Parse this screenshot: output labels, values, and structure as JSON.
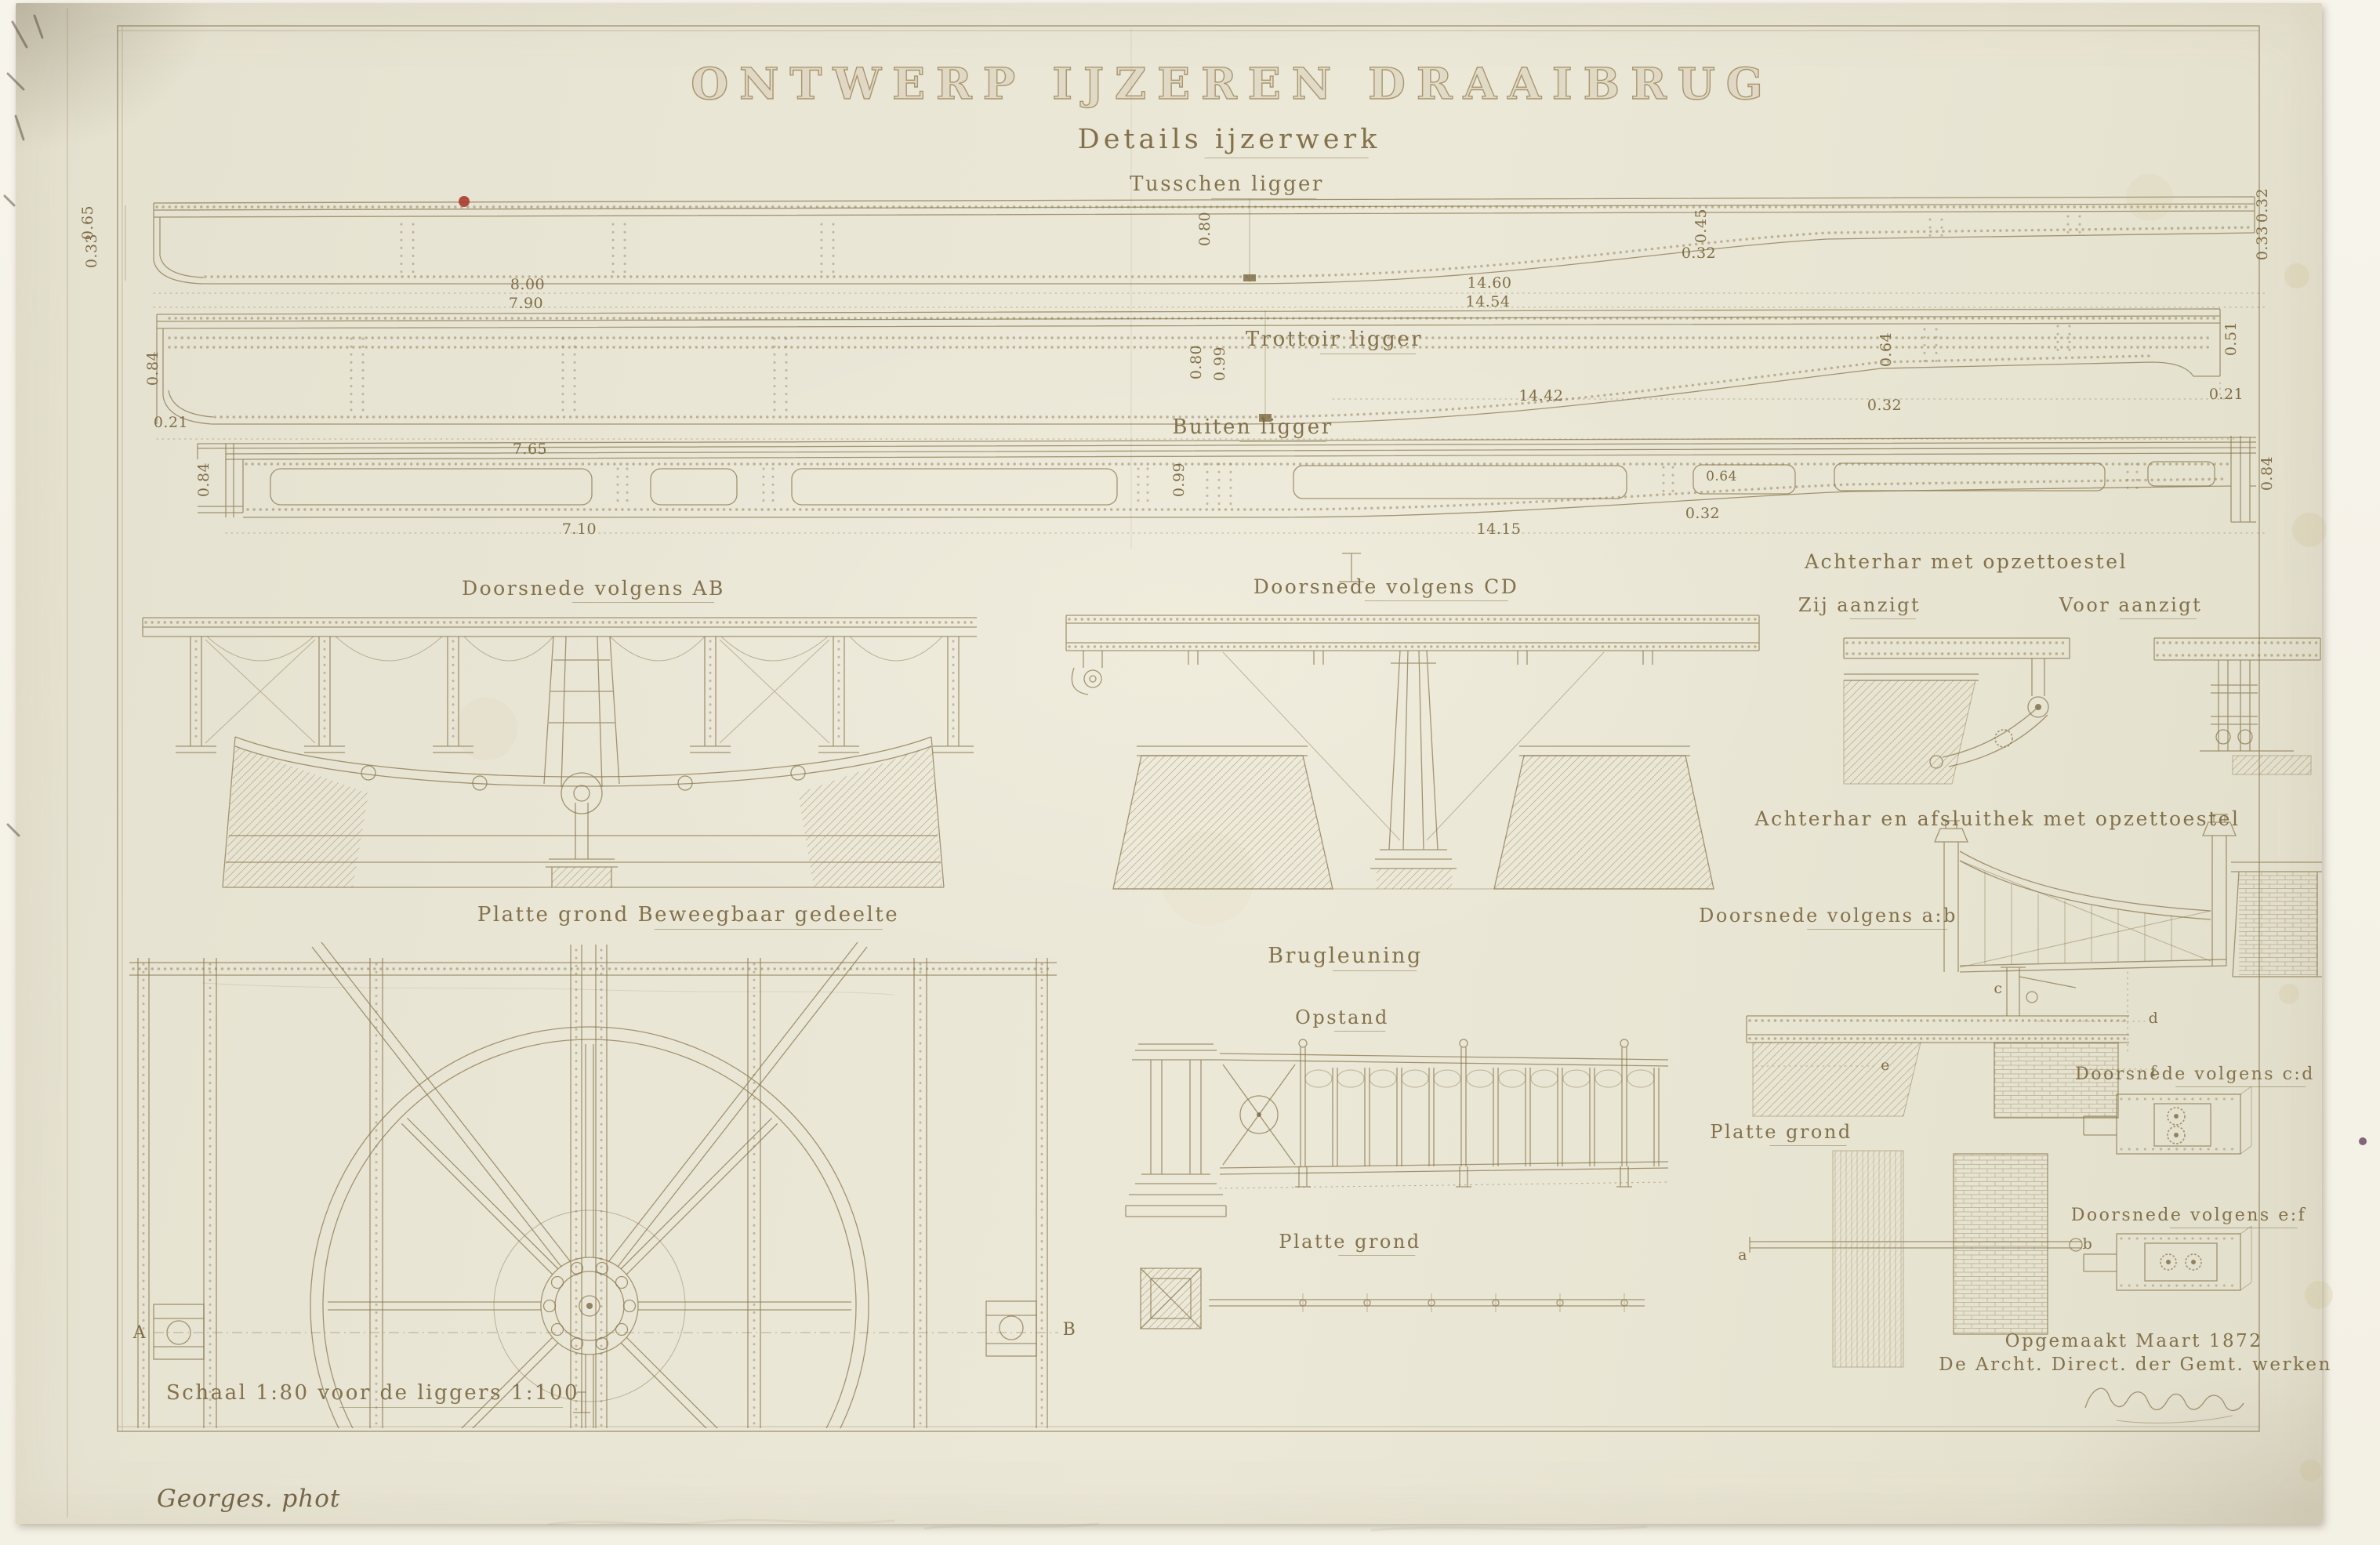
{
  "header": {
    "title": "ONTWERP IJZEREN DRAAIBRUG",
    "subtitle": "Details ijzerwerk"
  },
  "girders": {
    "tusschen": {
      "label": "Tusschen ligger",
      "dims": {
        "e1": "0.65",
        "e2": "0.33",
        "q1": "8.00",
        "q2": "7.90",
        "mid": "0.80",
        "h1": "14.60",
        "h2": "14.54",
        "t1": "0.45",
        "t2": "0.32",
        "r1": "0.32",
        "r2": "0.33"
      }
    },
    "trottoir": {
      "label": "Trottoir ligger",
      "dims": {
        "e1": "0.84",
        "e2": "0.21",
        "q1": "7.65",
        "m1": "0.80",
        "m2": "0.99",
        "h1": "14.42",
        "t1": "0.64",
        "t2": "0.32",
        "r1": "0.51",
        "r2": "0.21"
      }
    },
    "buiten": {
      "label": "Buiten ligger",
      "dims": {
        "e1": "0.84",
        "q1": "7.10",
        "m1": "0.99",
        "h1": "14.15",
        "t1": "0.64",
        "t2": "0.32",
        "r1": "0.84"
      }
    }
  },
  "sections": {
    "ab": {
      "label": "Doorsnede volgens AB"
    },
    "cd": {
      "label": "Doorsnede volgens CD"
    },
    "achterhar": {
      "label": "Achterhar met opzettoestel",
      "zij": "Zij aanzigt",
      "voor": "Voor aanzigt"
    },
    "afsluithek": {
      "label": "Achterhar en afsluithek met opzettoestel",
      "section_ab": "Doorsnede volgens a:b",
      "plan": "Platte grond",
      "section_cd": "Doorsnede volgens c:d",
      "section_ef": "Doorsnede volgens e:f"
    },
    "plan": {
      "label": "Platte grond Beweegbaar gedeelte",
      "marker_a": "A",
      "marker_b": "B"
    },
    "railing": {
      "label": "Brugleuning",
      "elevation": "Opstand",
      "plan": "Platte grond"
    }
  },
  "markers": {
    "a": "a",
    "b": "b",
    "c": "c",
    "d": "d",
    "e": "e",
    "f": "f"
  },
  "footer": {
    "scale_note": "Schaal 1:80 voor de liggers 1:100",
    "date_note": "Opgemaakt Maart 1872",
    "issuer_note": "De Archt. Direct. der Gemt. werken",
    "photographer": "Georges. phot"
  },
  "colors": {
    "ink": "#8d7b52",
    "paper": "#e9e5d4",
    "mount": "#f6f3ea",
    "accent_red": "#a8382b"
  }
}
